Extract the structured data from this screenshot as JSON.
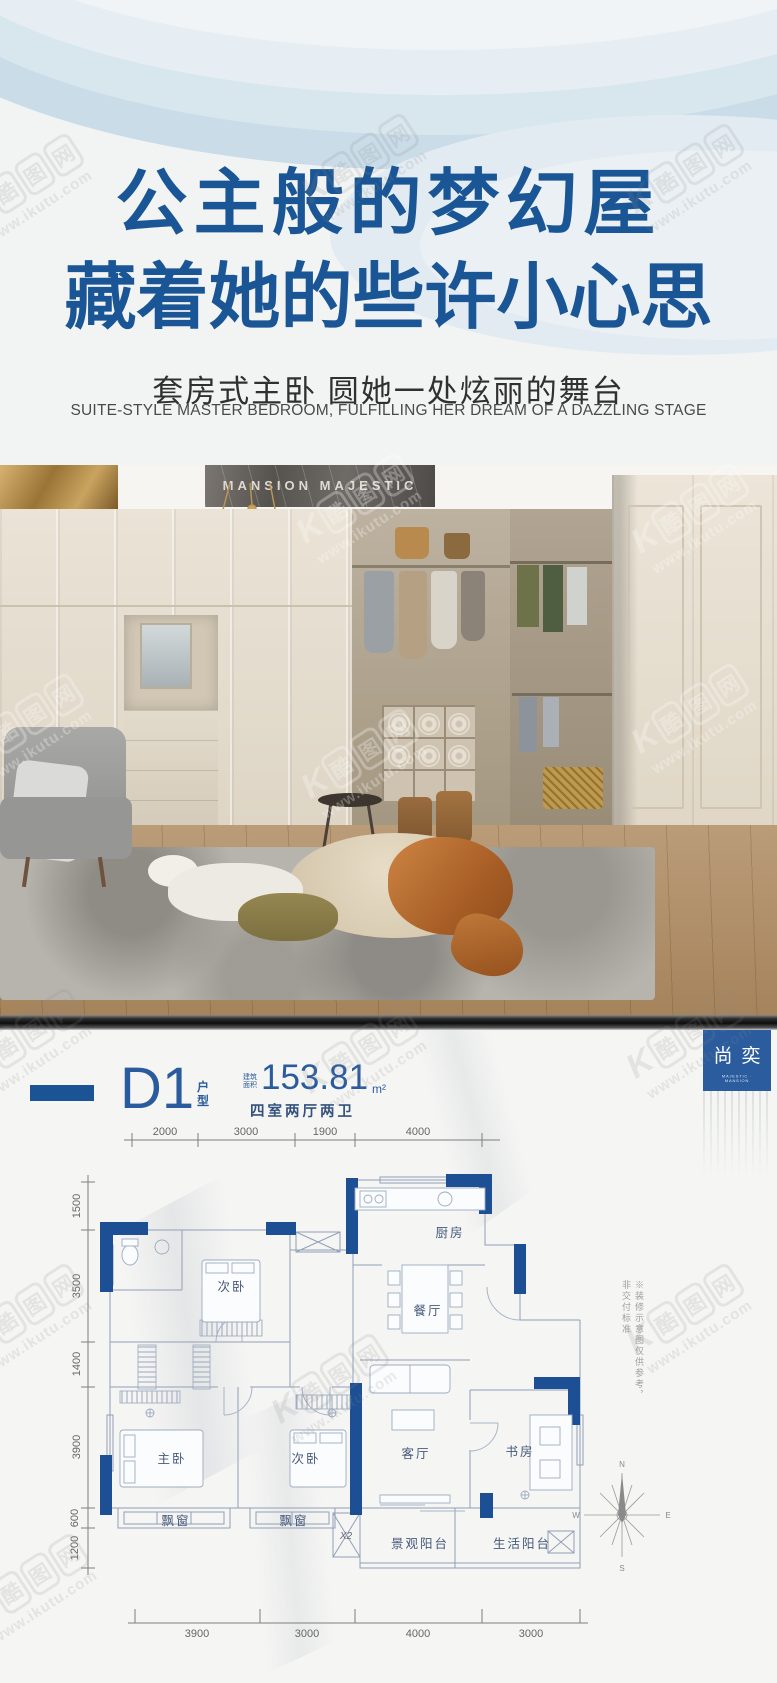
{
  "colors": {
    "headline_blue": "#1a5695",
    "accent_blue": "#1b5494",
    "navy_wall": "#1c4f94",
    "badge_blue": "#2a5c9e"
  },
  "hero": {
    "headline_line1": "公主般的梦幻屋",
    "headline_line2": "藏着她的些许小心思",
    "subtitle": "套房式主卧 圆她一处炫丽的舞台",
    "subtitle_en": "SUITE-STYLE MASTER BEDROOM, FULFILLING HER DREAM OF A DAZZLING STAGE"
  },
  "photo": {
    "plaque": "MANSION MAJESTIC"
  },
  "brand_badge": {
    "name": "尚奕",
    "tagline": "MAJESTIC · MANSION"
  },
  "plan_header": {
    "unit": "D1",
    "unit_type": "户型",
    "area_label": "建筑面积",
    "area_value": "153.81",
    "area_unit": "m²",
    "layout_desc": "四室两厅两卫"
  },
  "floor_plan": {
    "dims_top": [
      "2000",
      "3000",
      "1900",
      "4000"
    ],
    "dims_left": [
      "1500",
      "3500",
      "1400",
      "3900",
      "600",
      "1200"
    ],
    "dims_bottom": [
      "3900",
      "3000",
      "4000",
      "3000"
    ],
    "rooms": {
      "bedroom_top": "次卧",
      "kitchen": "厨房",
      "dining": "餐厅",
      "master": "主卧",
      "bedroom_mid": "次卧",
      "living": "客厅",
      "study": "书房",
      "bay_window_left": "飘窗",
      "bay_window_mid": "飘窗",
      "shaft": "X2",
      "balcony_view": "景观阳台",
      "balcony_life": "生活阳台"
    },
    "note": "※装修示意图仅供参考，非交付标准",
    "compass": {
      "n": "N",
      "e": "E",
      "s": "S",
      "w": "W"
    }
  },
  "watermark": {
    "k": "K",
    "c1": "酷",
    "c2": "图",
    "c3": "网",
    "url": "www.ikutu.com"
  }
}
